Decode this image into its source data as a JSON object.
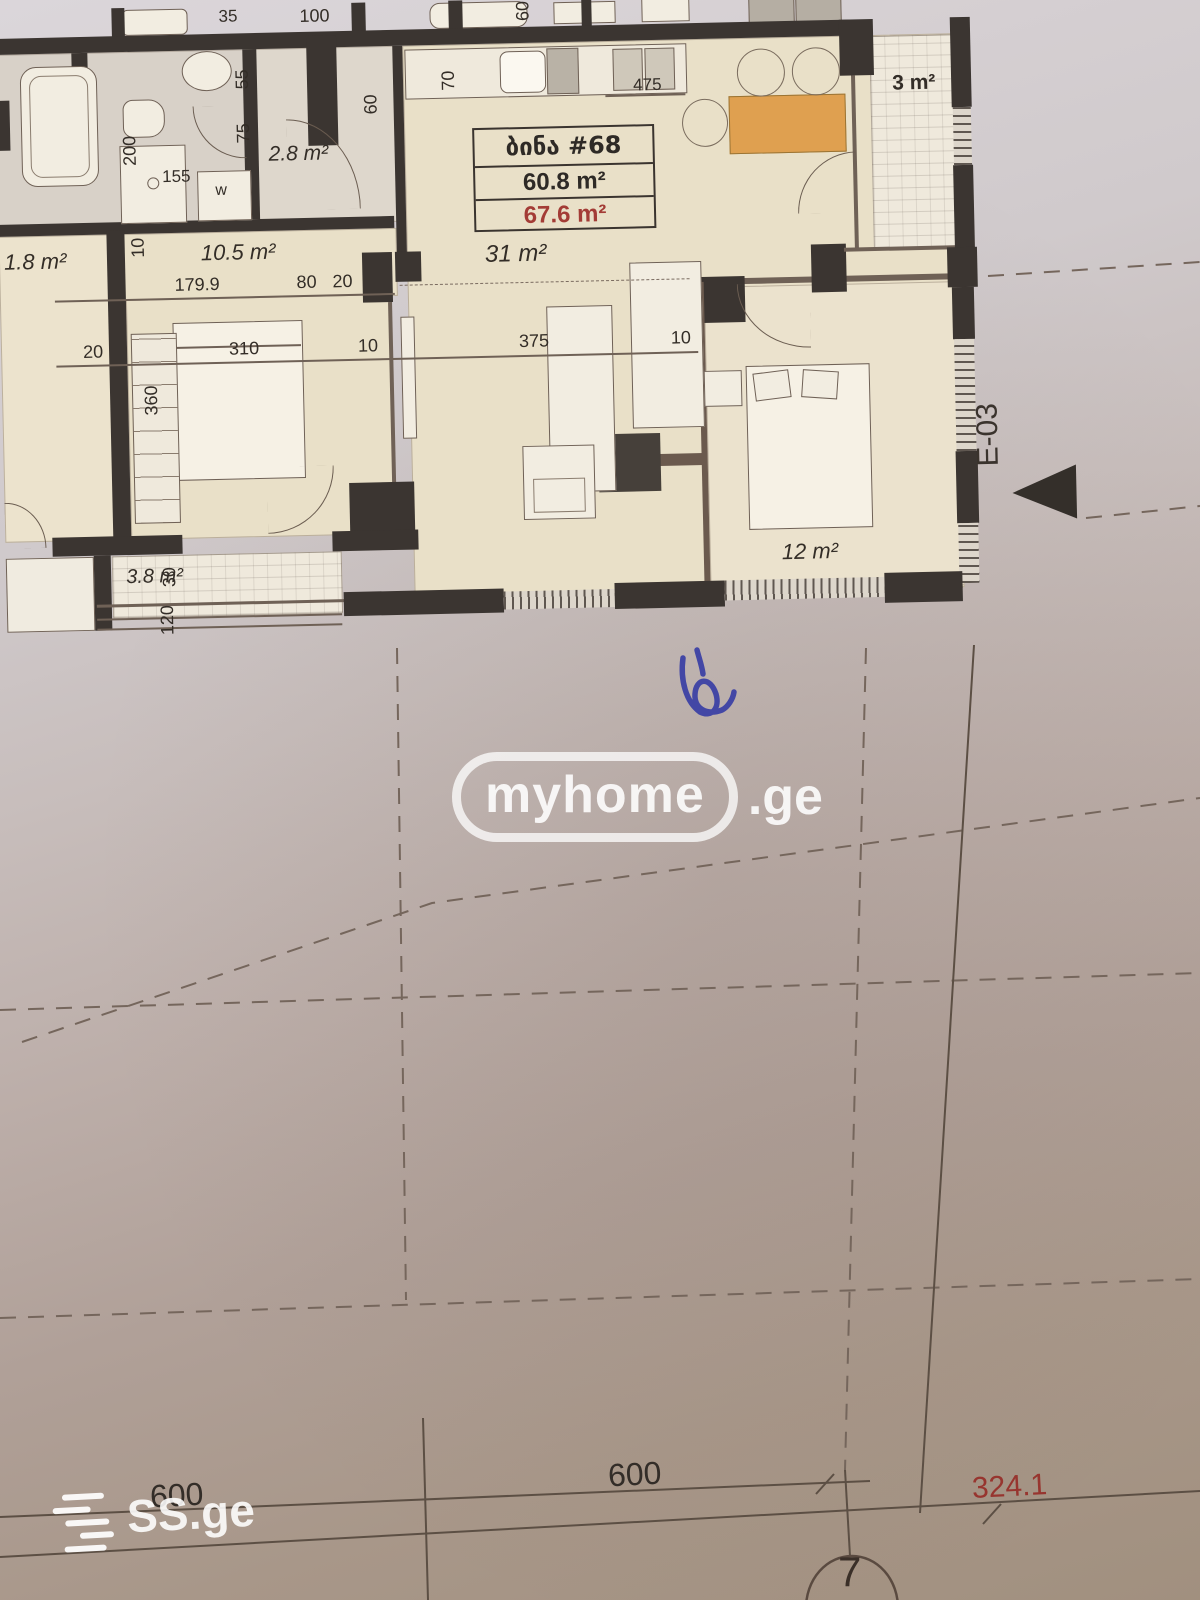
{
  "plan": {
    "unit_box": {
      "title": "ბინა #68",
      "area1": "60.8 m²",
      "area2": "67.6 m²"
    },
    "areas": {
      "living": "31 m²",
      "bedroom": "12 m²",
      "balcony_right": "3 m²",
      "balcony_left": "3.8 m²",
      "wc": "2.8 m²",
      "hall": "10.5 m²",
      "neighbor_left": "1.8 m²"
    },
    "dims": {
      "top_a": "35",
      "top_b": "100",
      "left_v1": "55",
      "left_v2": "75",
      "left_v3": "200",
      "left_d1": "155",
      "left_v4": "10",
      "washer": "w",
      "hall_len": "179.9",
      "hall_a": "80",
      "hall_b": "20",
      "bed_a": "20",
      "bed_len": "310",
      "bed_b": "10",
      "bed_h": "360",
      "kit_v1": "60",
      "kit_v2": "70",
      "kit_v3": "60",
      "kit_len": "475",
      "sofa_len": "375",
      "sofa_b": "10",
      "balc_a": "30",
      "balc_b": "120"
    },
    "grid": {
      "section_label": "E-03",
      "bubble": "7"
    }
  },
  "bottom": {
    "dim1": "600",
    "dim2": "600",
    "dim3": "324.1"
  },
  "watermarks": {
    "brand": "myhome",
    "tld": ".ge",
    "corner": "SS.ge"
  },
  "colors": {
    "wall": "#3b3531",
    "accent_orange": "#dfa050",
    "dim_red": "#97352f",
    "pen_blue": "#4347a5"
  }
}
